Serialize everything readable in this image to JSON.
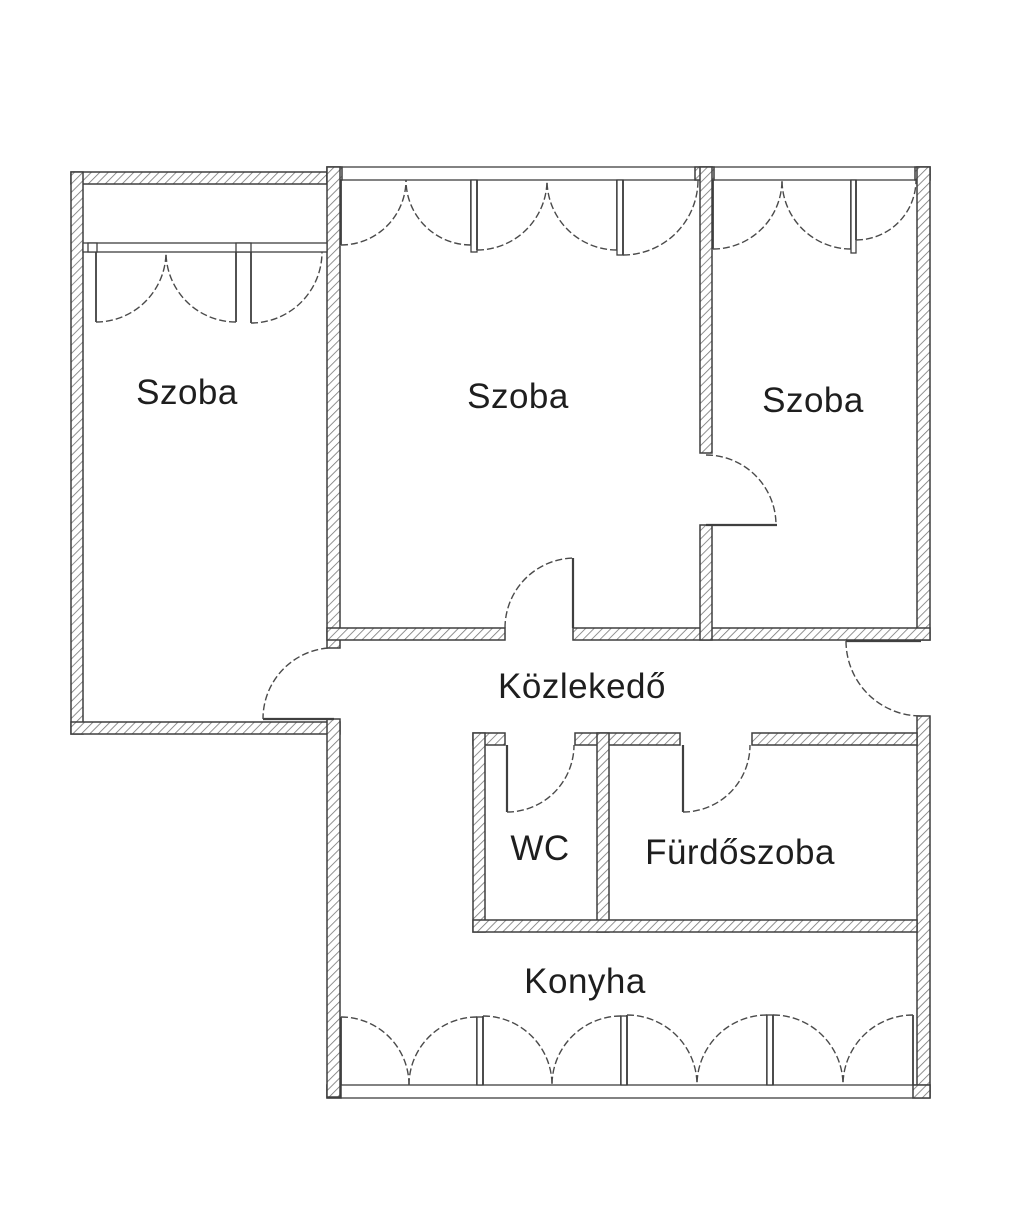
{
  "plan": {
    "rooms": [
      {
        "id": "szoba-left",
        "label": "Szoba"
      },
      {
        "id": "szoba-middle",
        "label": "Szoba"
      },
      {
        "id": "szoba-right",
        "label": "Szoba"
      },
      {
        "id": "kozlekedo",
        "label": "Közlekedő"
      },
      {
        "id": "wc",
        "label": "WC"
      },
      {
        "id": "furdoszoba",
        "label": "Fürdőszoba"
      },
      {
        "id": "konyha",
        "label": "Konyha"
      }
    ],
    "colors": {
      "background": "#ffffff",
      "wall_line": "#3f3f3f",
      "swing_line": "#4a4a4a",
      "hatch": "#757575",
      "label_text": "#1e1e1e"
    }
  }
}
